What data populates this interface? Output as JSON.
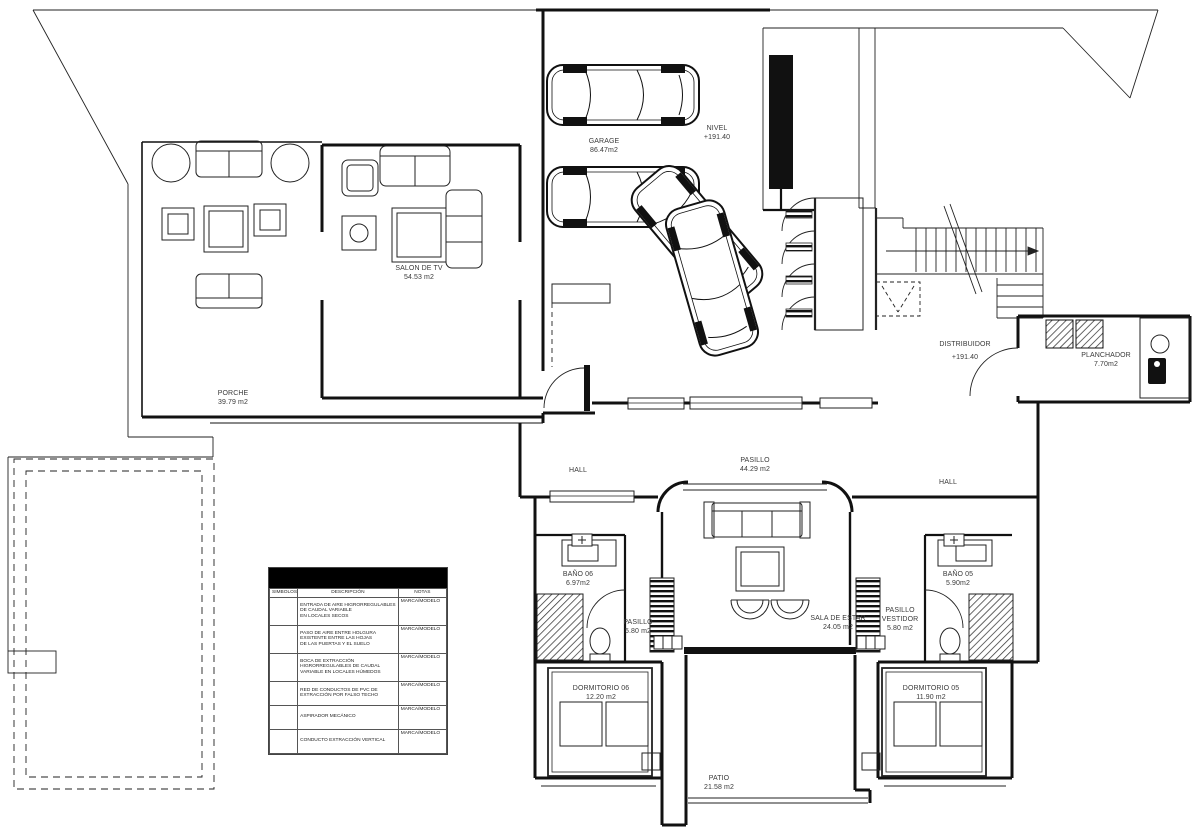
{
  "rooms": {
    "garage": {
      "name": "GARAGE",
      "area": "86.47m2"
    },
    "nivel": {
      "name": "NIVEL",
      "value": "+191.40"
    },
    "salon_de_tv": {
      "name": "SALON DE TV",
      "area": "54.53 m2"
    },
    "porche": {
      "name": "PORCHE",
      "area": "39.79 m2"
    },
    "distribuidor": {
      "name": "DISTRIBUIDOR",
      "value": "+191.40"
    },
    "planchador": {
      "name": "PLANCHADOR",
      "area": "7.70m2"
    },
    "hall_left": {
      "name": "HALL"
    },
    "hall_right": {
      "name": "HALL"
    },
    "pasillo": {
      "name": "PASILLO",
      "area": "44.29 m2"
    },
    "bano_06": {
      "name": "BAÑO 06",
      "area": "6.97m2"
    },
    "bano_05": {
      "name": "BAÑO 05",
      "area": "5.90m2"
    },
    "pasillo_06": {
      "name": "PASILLO",
      "area": "5.80 m2"
    },
    "sala_de_estar": {
      "name": "SALA DE ESTAR",
      "area": "24.05 m2"
    },
    "pasillo_vestidor": {
      "name": "PASILLO\nVESTIDOR",
      "area": "5.80 m2"
    },
    "dormitorio_06": {
      "name": "DORMITORIO 06",
      "area": "12.20 m2"
    },
    "dormitorio_05": {
      "name": "DORMITORIO 05",
      "area": "11.90 m2"
    },
    "patio": {
      "name": "PATIO",
      "area": "21.58 m2"
    }
  },
  "legend": {
    "headers": {
      "simbolos": "SIMBOLOS",
      "descripcion": "DESCRIPCIÓN",
      "notas": "NOTAS"
    },
    "rows": [
      {
        "descripcion": "ENTRADA DE AIRE HIGRORREGULABLES\nDE CAUDAL VARIABLE\nEN LOCALES SECOS",
        "notas": "MARCA/MODELO"
      },
      {
        "descripcion": "PASO DE AIRE ENTRE HOLGURA\nEXISTENTE ENTRE LAS HOJAS\nDE LAS PUERTAS Y EL SUELO",
        "notas": "MARCA/MODELO"
      },
      {
        "descripcion": "BOCA DE EXTRACCIÓN\nHIGRORREGULABLES DE CAUDAL\nVARIABLE EN LOCALES HÚMEDOS",
        "notas": "MARCA/MODELO"
      },
      {
        "descripcion": "RED DE CONDUCTOS DE PVC DE\nEXTRACCIÓN POR FALSO TECHO",
        "notas": "MARCA/MODELO"
      },
      {
        "descripcion": "ASPIRADOR MECÁNICO",
        "notas": "MARCA/MODELO"
      },
      {
        "descripcion": "CONDUCTO EXTRACCIÓN VERTICAL",
        "notas": "MARCA/MODELO"
      }
    ]
  },
  "colors": {
    "line": "#1a1a1a",
    "background": "#ffffff",
    "legend_header_bg": "#000000"
  }
}
